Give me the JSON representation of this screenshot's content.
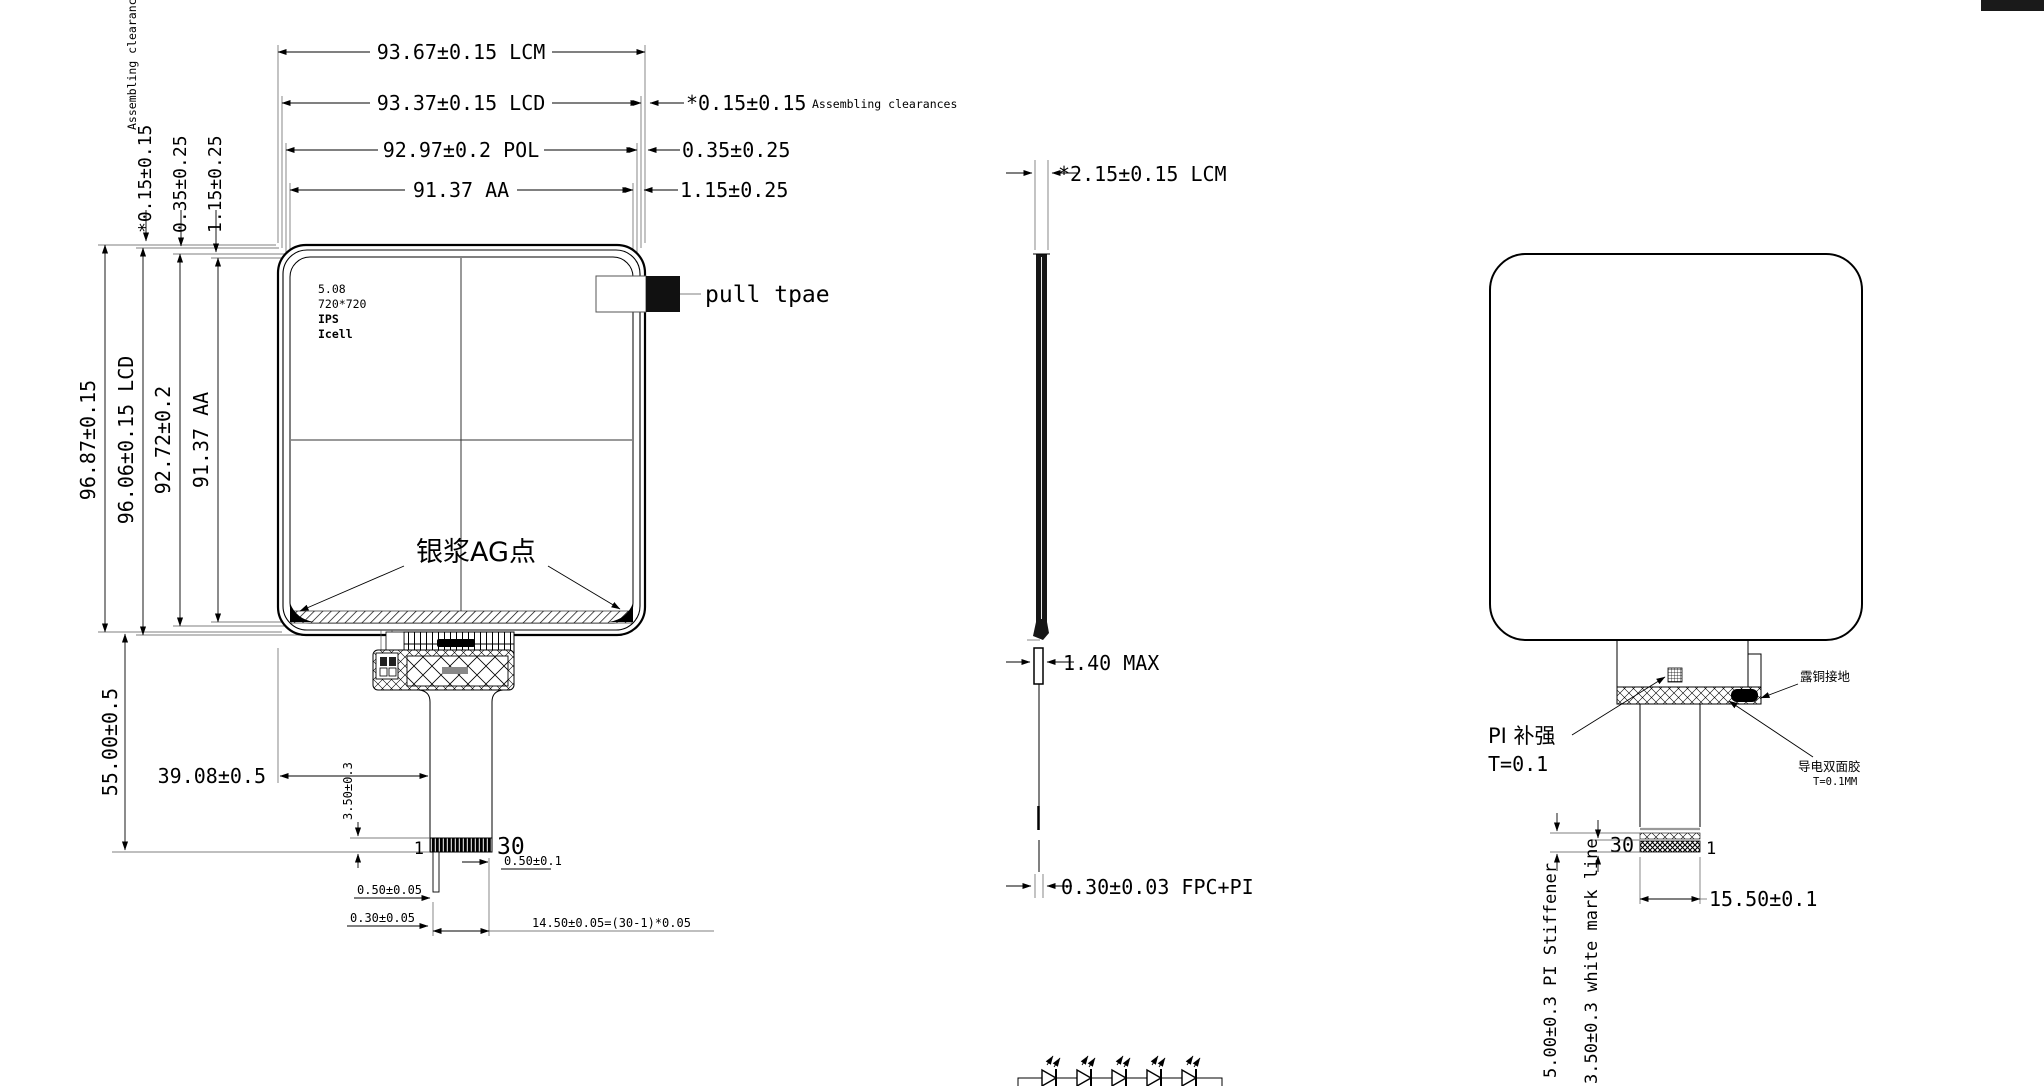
{
  "front": {
    "dim_top_1": "93.67±0.15 LCM",
    "dim_top_2": "93.37±0.15 LCD",
    "dim_top_2_side": "*0.15±0.15",
    "dim_top_2_note": "Assembling clearances",
    "dim_top_3": "92.97±0.2 POL",
    "dim_top_3_side": "0.35±0.25",
    "dim_top_4": "91.37 AA",
    "dim_top_4_side": "1.15±0.25",
    "dim_left_1": "96.87±0.15",
    "dim_left_2": "96.06±0.15 LCD",
    "dim_left_3": "92.72±0.2",
    "dim_left_4": "91.37 AA",
    "corner_note": "Assembling clearances",
    "corner_dim_1": "*0.15±0.15",
    "corner_dim_2": "0.35±0.25",
    "corner_dim_3": "1.15±0.25",
    "panel_line_1": "5.08",
    "panel_line_2": "720*720",
    "panel_line_3": "IPS",
    "panel_line_4": "Icell",
    "pull_tab": "pull tpae",
    "ag_dots": "银浆AG点",
    "dim_55": "55.00±0.5",
    "dim_39": "39.08±0.5",
    "dim_35": "3.50±0.3",
    "pin_first": "1",
    "pin_last": "30",
    "dim_pitch": "0.50±0.1",
    "dim_pin_w": "0.50±0.05",
    "dim_pin_w2": "0.30±0.05",
    "dim_total": "14.50±0.05=(30-1)*0.05"
  },
  "side": {
    "dim_thickness": "*2.15±0.15 LCM",
    "dim_max": "1.40 MAX",
    "dim_fpc": "0.30±0.03 FPC+PI"
  },
  "back": {
    "pi_label": "PI 补强",
    "pi_thickness": "T=0.1",
    "copper_note": "露铜接地",
    "tape_label": "导电双面胶",
    "tape_thickness": "T=0.1MM",
    "pin_last": "30",
    "pin_first": "1",
    "dim_width": "15.50±0.1",
    "dim_stiffener": "5.00±0.3 PI Stiffener",
    "dim_markline": "3.50±0.3 white mark line"
  }
}
